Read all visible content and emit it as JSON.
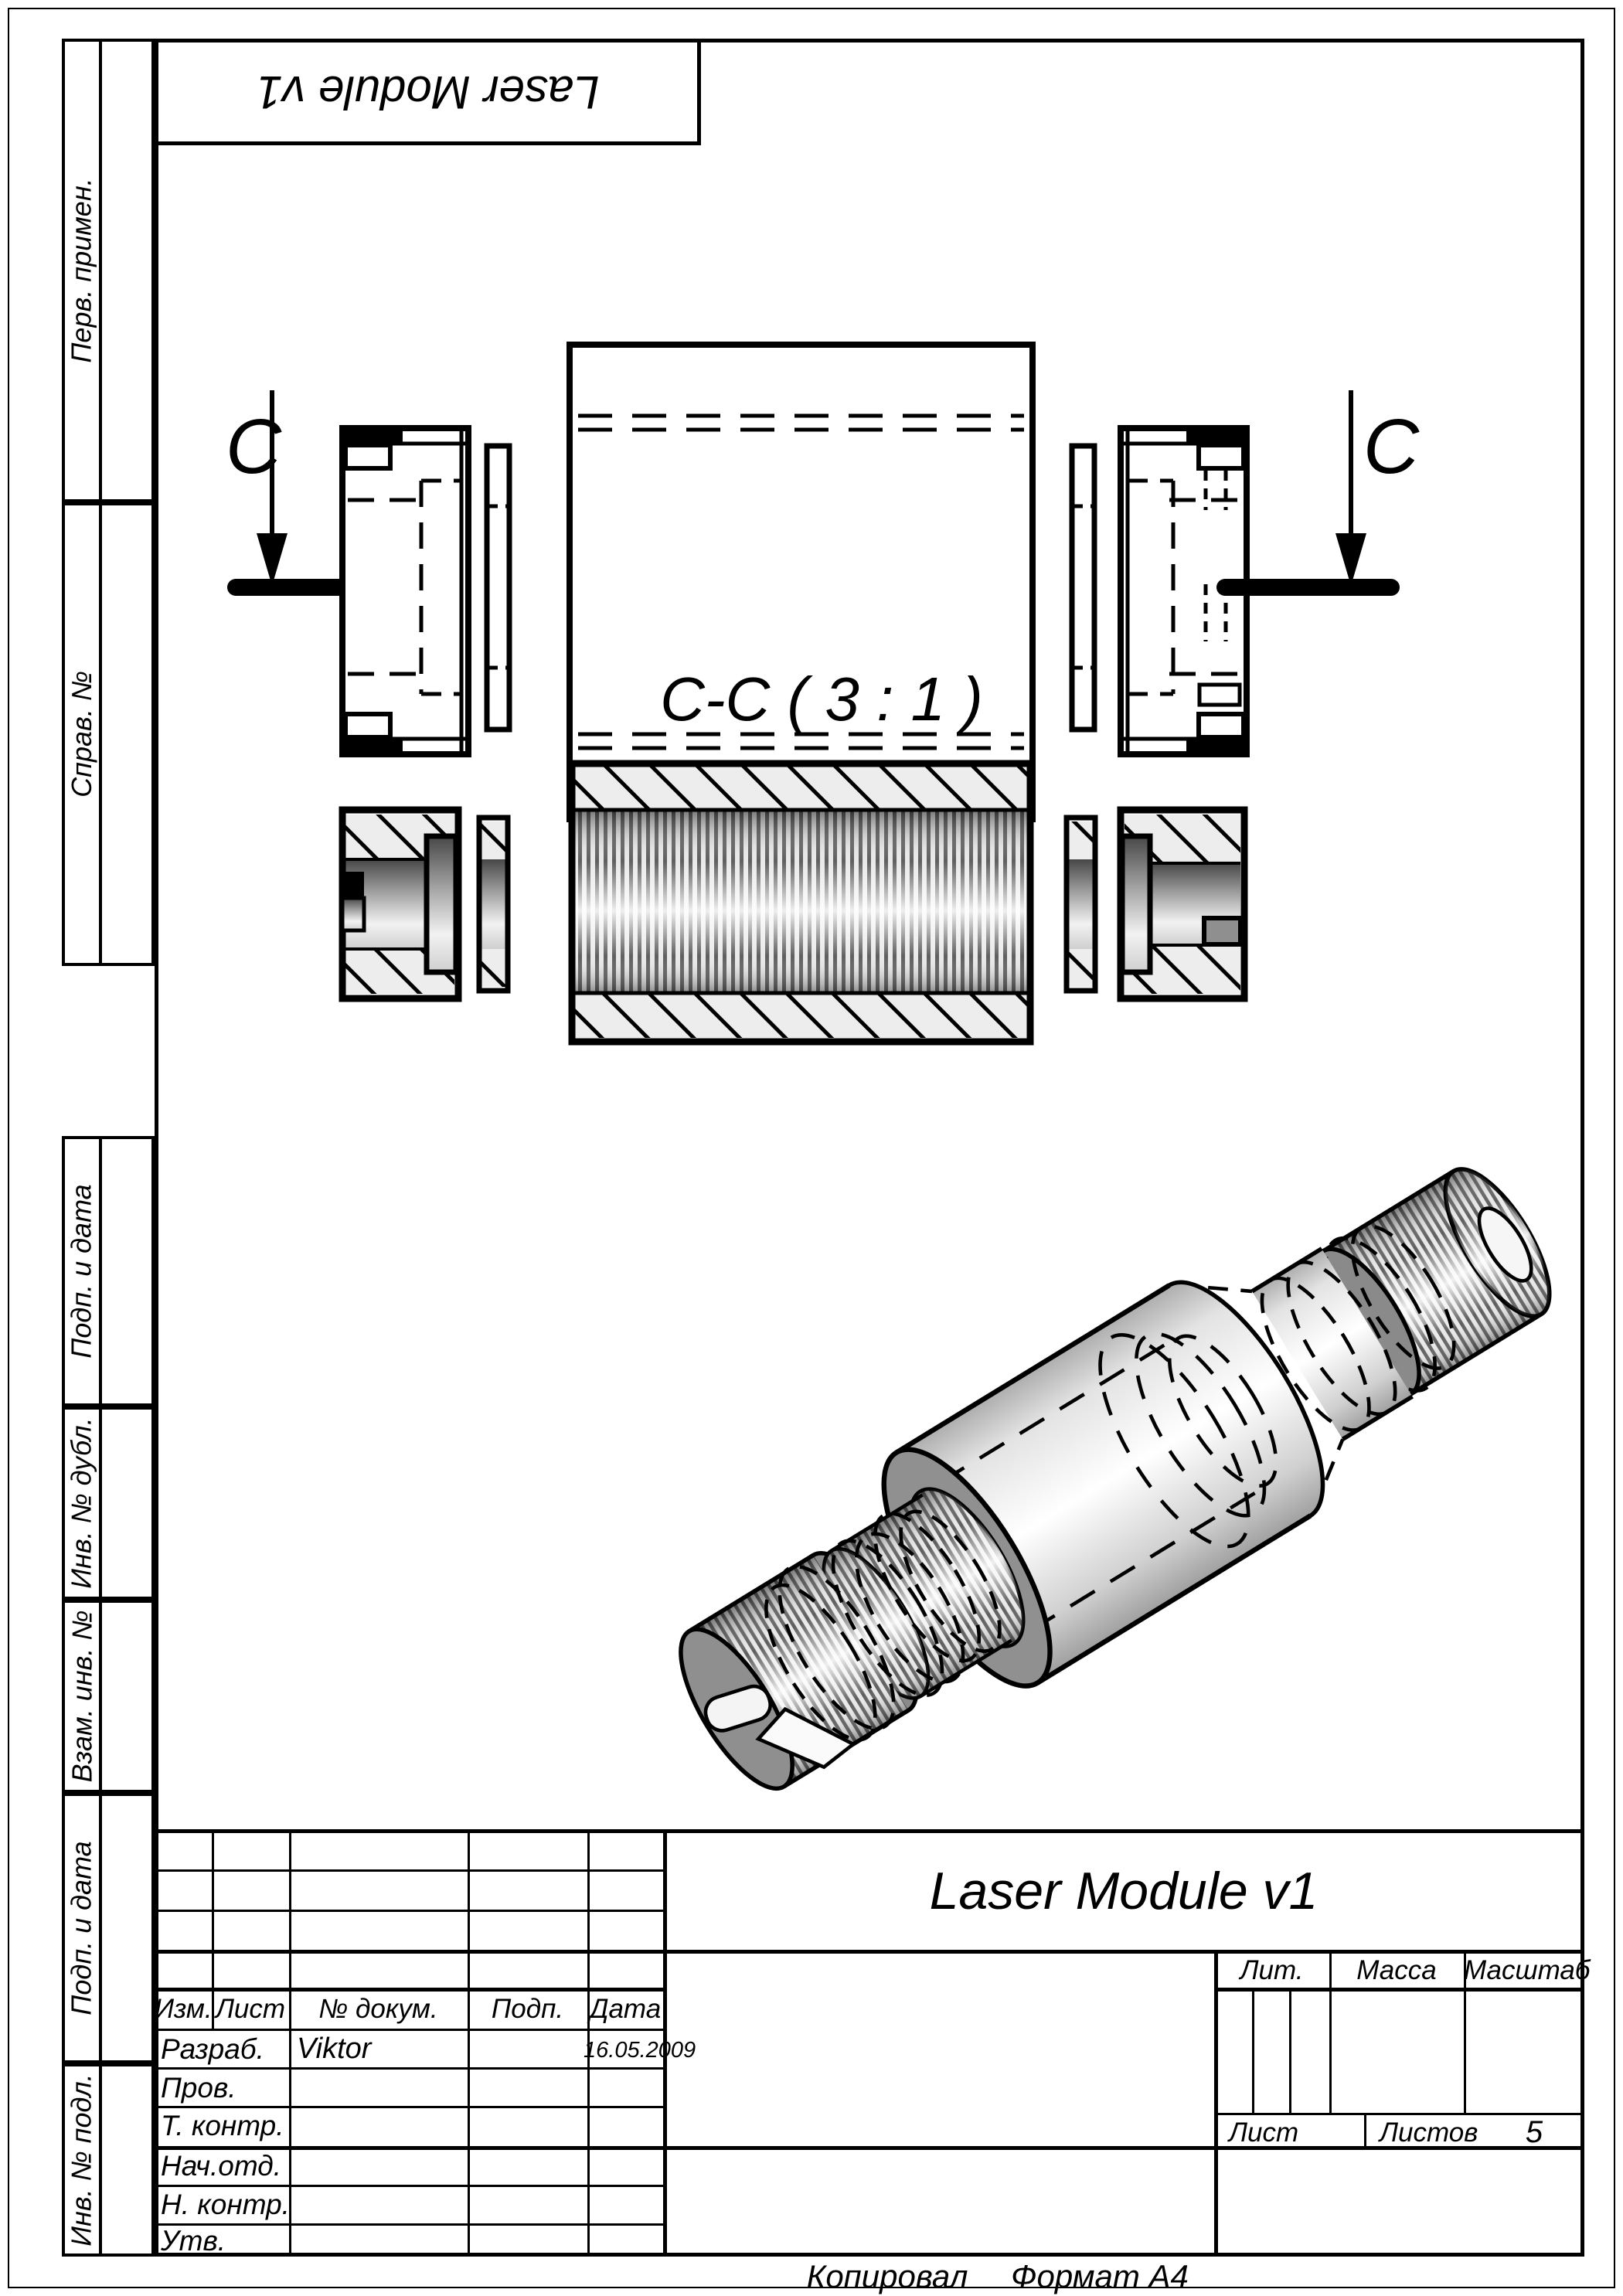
{
  "header_box": {
    "title": "Laser Module v1"
  },
  "sidebar": {
    "items": [
      {
        "label": "Перв. примен."
      },
      {
        "label": "Справ. №"
      },
      {
        "label": "Подп. и дата"
      },
      {
        "label": "Инв. № дубл."
      },
      {
        "label": "Взам. инв. №"
      },
      {
        "label": "Подп. и дата"
      },
      {
        "label": "Инв. № подл."
      }
    ]
  },
  "drawing": {
    "section_label": "C-C ( 3 : 1 )",
    "cut_letter_left": "C",
    "cut_letter_right": "C"
  },
  "title_block": {
    "title": "Laser Module v1",
    "header": {
      "izm": "Изм.",
      "list": "Лист",
      "doc_no": "№ докум.",
      "podp": "Подп.",
      "date": "Дата"
    },
    "rows": [
      {
        "label": "Разраб.",
        "name": "Viktor",
        "date": "16.05.2009"
      },
      {
        "label": "Пров.",
        "name": "",
        "date": ""
      },
      {
        "label": "Т. контр.",
        "name": "",
        "date": ""
      },
      {
        "label": "Нач.отд.",
        "name": "",
        "date": ""
      },
      {
        "label": "Н. контр.",
        "name": "",
        "date": ""
      },
      {
        "label": "Утв.",
        "name": "",
        "date": ""
      }
    ],
    "lit_label": "Лит.",
    "mass_label": "Масса",
    "scale_label": "Масштаб",
    "sheet_label": "Лист",
    "sheets_label": "Листов",
    "sheets_value": "5"
  },
  "footer": {
    "copied_label": "Копировал",
    "format_label": "Формат А4"
  }
}
